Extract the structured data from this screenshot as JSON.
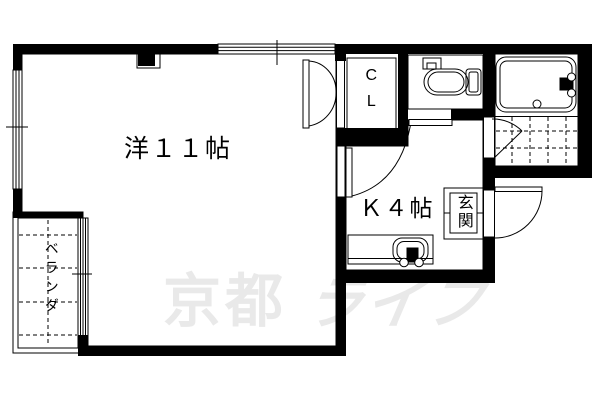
{
  "floorplan": {
    "rooms": {
      "main_room": {
        "label": "洋１１帖"
      },
      "kitchen": {
        "label": "Ｋ４帖"
      },
      "closet": {
        "label": "CL"
      },
      "entrance": {
        "label": "玄関"
      },
      "veranda": {
        "label": "ベランダ"
      }
    },
    "fixtures": [
      "bathtub",
      "toilet",
      "kitchen-stove",
      "entrance-step"
    ],
    "watermark": {
      "kanji": "京都",
      "kana": "ライフ",
      "color": "#e9e9e9"
    },
    "colors": {
      "wall": "#000000",
      "line": "#000000",
      "background": "#ffffff"
    }
  }
}
